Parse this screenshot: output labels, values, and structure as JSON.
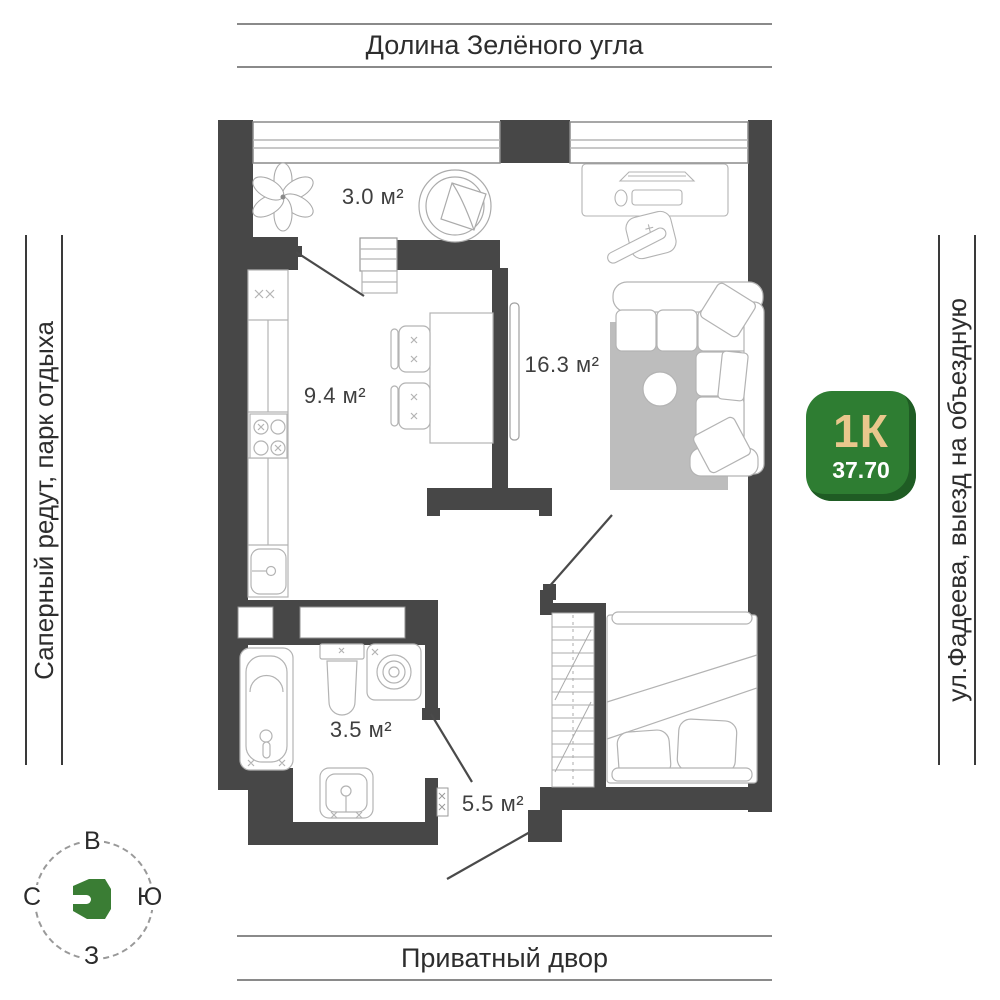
{
  "surroundings": {
    "top": "Долина Зелёного угла",
    "bottom": "Приватный двор",
    "left": "Саперный редут, парк отдыха",
    "right": "ул.Фадеева, выезд на объездную"
  },
  "badge": {
    "rooms": "1К",
    "area": "37.70",
    "bg_color": "#2e7d32",
    "edge_color": "#1f5c24",
    "rooms_color": "#e9c78c",
    "area_color": "#ffffff"
  },
  "compass": {
    "top": "В",
    "left": "С",
    "right": "Ю",
    "bottom": "З",
    "logo_color": "#3a7d34"
  },
  "rooms": {
    "balcony": {
      "label": "3.0 м²"
    },
    "kitchen": {
      "label": "9.4 м²"
    },
    "living": {
      "label": "16.3 м²"
    },
    "bathroom": {
      "label": "3.5 м²"
    },
    "hallway": {
      "label": "5.5 м²"
    }
  },
  "colors": {
    "walls": "#474747",
    "furniture": "#b3b3b3",
    "rug": "#bdbdbd",
    "label_text": "#3f3f3f"
  }
}
